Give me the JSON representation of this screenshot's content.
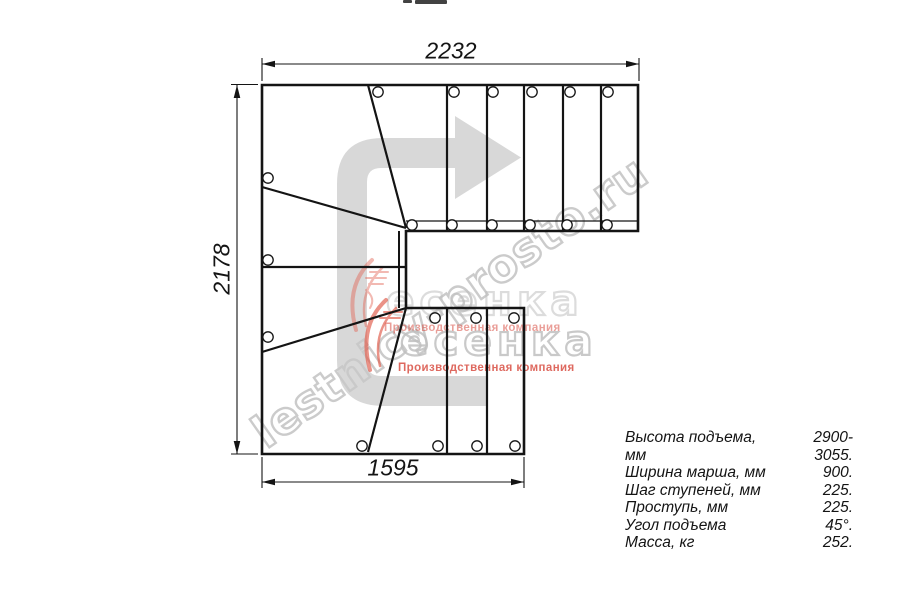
{
  "drawing": {
    "type": "staircase-plan-180-turn",
    "dimensions": {
      "top_width_mm": "2232",
      "left_height_mm": "2178",
      "bottom_width_mm": "1595"
    }
  },
  "specs": {
    "rows": [
      {
        "label": "Высота подъема, мм",
        "value": "2900-3055."
      },
      {
        "label": "Ширина марша, мм",
        "value": "900."
      },
      {
        "label": "Шаг ступеней, мм",
        "value": "225."
      },
      {
        "label": "Проступь, мм",
        "value": "225."
      },
      {
        "label": "Угол подъема",
        "value": "45°."
      },
      {
        "label": "Масса, кг",
        "value": "252."
      }
    ]
  },
  "watermarks": {
    "site": "lestnicy-prosto.ru",
    "brand_text": "есенка",
    "tagline": "Производственная компания"
  },
  "icons": {
    "direction_arrow": "gray C-shaped walk-direction arrow pointing right",
    "brand_swoosh": "red swoosh (stylized Л)"
  },
  "colors": {
    "line": "#141414",
    "arrow_gray": "#d8d8d8",
    "watermark_gray": "#c9c9c9",
    "brand_red": "#d94f44"
  }
}
